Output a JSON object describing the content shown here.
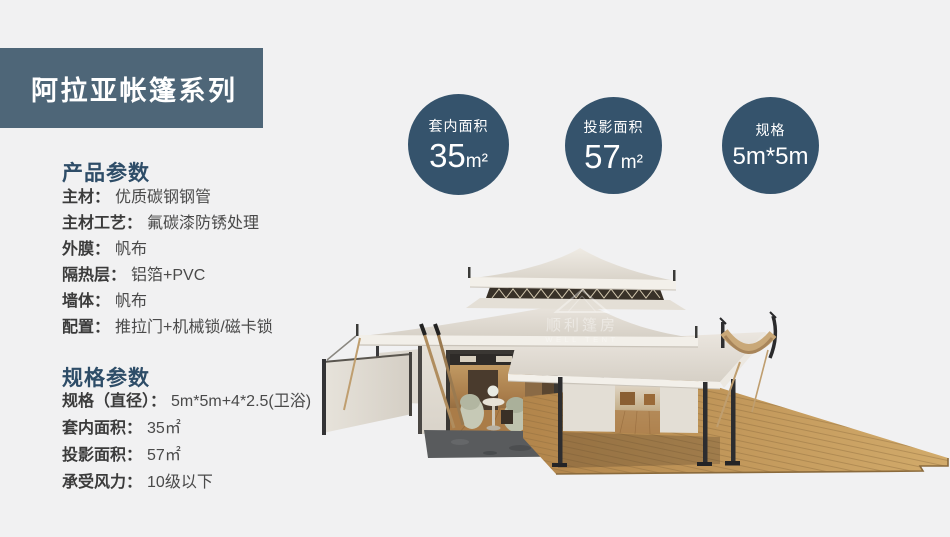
{
  "banner": {
    "title": "阿拉亚帐篷系列",
    "bg_color": "#4e6678"
  },
  "badges": [
    {
      "label": "套内面积",
      "value": "35",
      "unit": "m²"
    },
    {
      "label": "投影面积",
      "value": "57",
      "unit": "m²"
    },
    {
      "label": "规格",
      "value": "5m*5m",
      "unit": ""
    }
  ],
  "sections": {
    "product": {
      "title": "产品参数",
      "rows": [
        {
          "label": "主材：",
          "value": "优质碳钢钢管"
        },
        {
          "label": "主材工艺：",
          "value": "氟碳漆防锈处理"
        },
        {
          "label": "外膜：",
          "value": "帆布"
        },
        {
          "label": "隔热层：",
          "value": "铝箔+PVC"
        },
        {
          "label": "墙体：",
          "value": "帆布"
        },
        {
          "label": "配置：",
          "value": "推拉门+机械锁/磁卡锁"
        }
      ]
    },
    "spec": {
      "title": "规格参数",
      "rows": [
        {
          "label": "规格（直径）：",
          "value": "5m*5m+4*2.5(卫浴)"
        },
        {
          "label": "套内面积：",
          "value": "35㎡"
        },
        {
          "label": "投影面积：",
          "value": "57㎡"
        },
        {
          "label": "承受风力：",
          "value": "10级以下"
        }
      ]
    }
  },
  "watermark": {
    "cn": "顺利篷房",
    "en": "WELL TENT"
  },
  "colors": {
    "page_bg": "#f1f1f2",
    "banner_bg": "#4e6678",
    "badge_bg": "#35536c",
    "heading_text": "#2e4d68",
    "roof_cream": "#e8e3db",
    "deck_wood": "#c49a5e"
  }
}
